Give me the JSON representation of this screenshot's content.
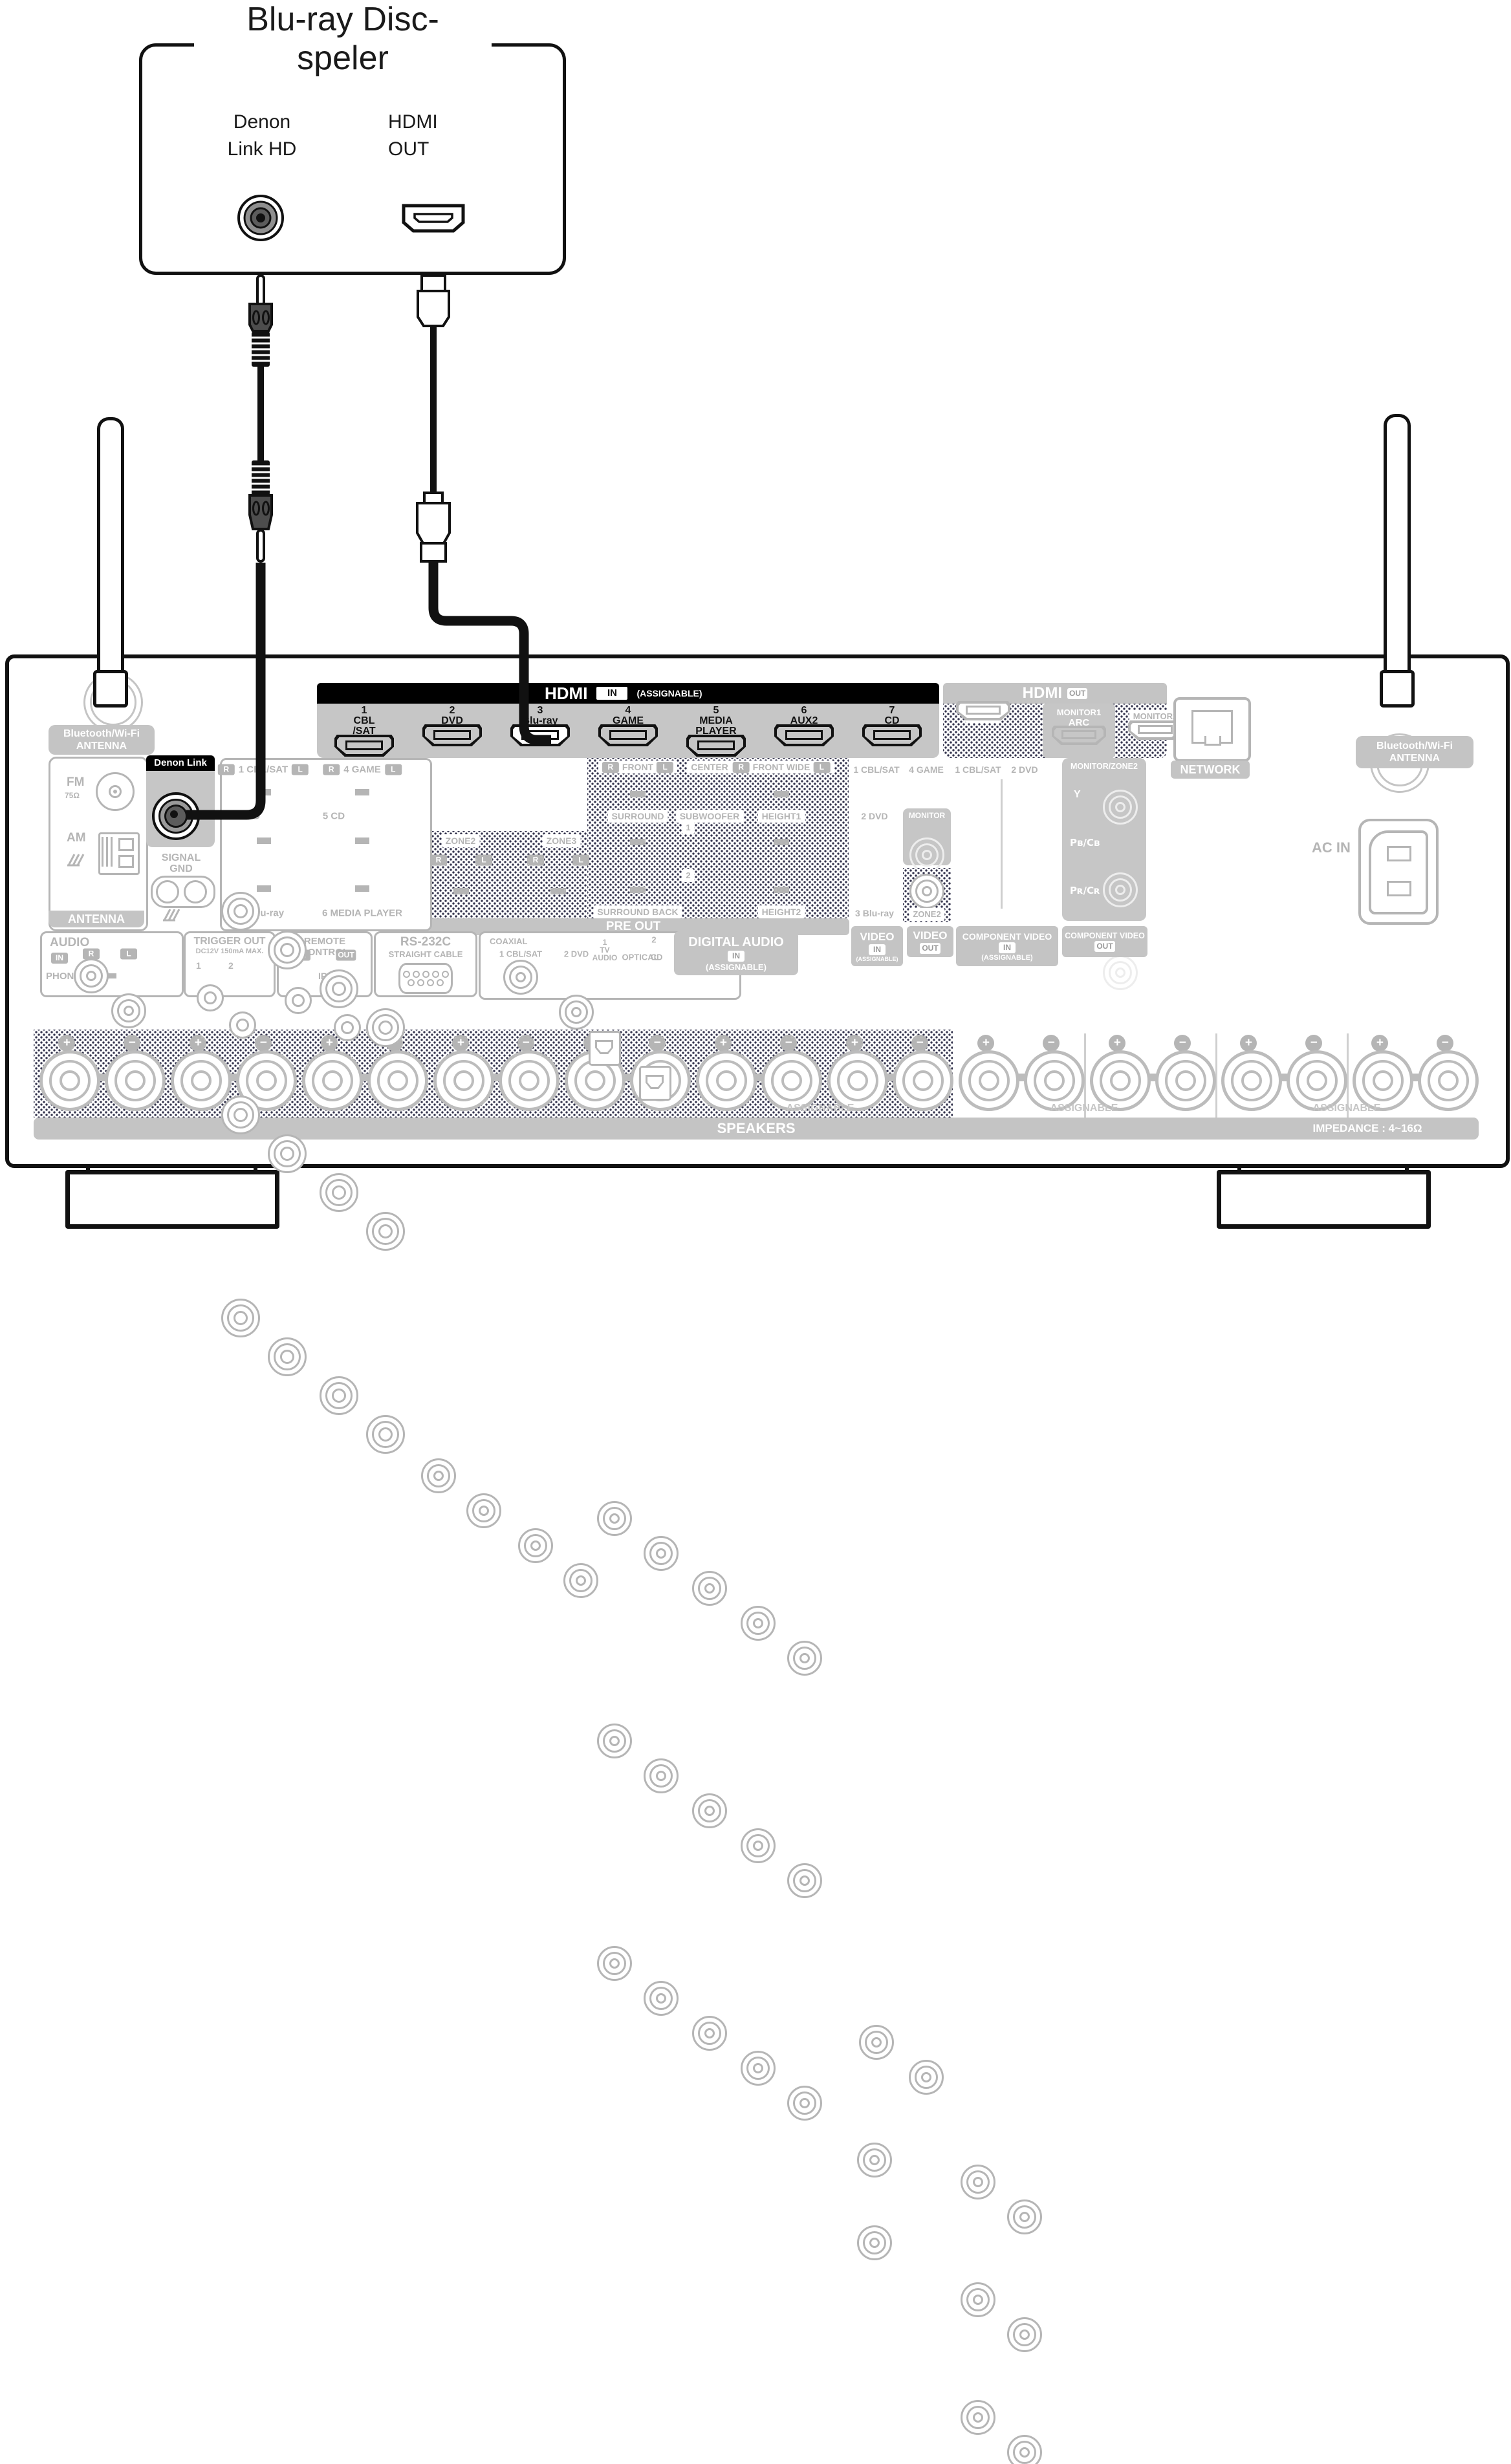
{
  "player": {
    "title": "Blu-ray Disc-\nspeler",
    "denon_link_label": "Denon\nLink HD",
    "hdmi_out_label": "HDMI\nOUT"
  },
  "receiver": {
    "bt_antenna": "Bluetooth/Wi-Fi\nANTENNA",
    "hdmi_in": {
      "title": "HDMI",
      "badge": "IN",
      "note": "(ASSIGNABLE)",
      "ports": [
        {
          "n": "1",
          "name": "CBL\n/SAT"
        },
        {
          "n": "2",
          "name": "DVD"
        },
        {
          "n": "3",
          "name": "Blu-ray"
        },
        {
          "n": "4",
          "name": "GAME"
        },
        {
          "n": "5",
          "name": "MEDIA\nPLAYER"
        },
        {
          "n": "6",
          "name": "AUX2"
        },
        {
          "n": "7",
          "name": "CD"
        }
      ]
    },
    "hdmi_out": {
      "title": "HDMI",
      "badge": "OUT",
      "zone2": "ZONE2",
      "monitor1": "MONITOR1",
      "arc": "ARC",
      "monitor2": "MONITOR2"
    },
    "network": "NETWORK",
    "antenna": {
      "fm": "FM",
      "ohm": "75Ω",
      "am": "AM",
      "banner": "ANTENNA"
    },
    "denon_link": {
      "label": "Denon Link HD",
      "gnd": "SIGNAL\nGND"
    },
    "audio_in": {
      "title": "AUDIO",
      "badge": "IN",
      "note": "(ASSIGNABLE)",
      "r": "R",
      "l": "L",
      "in1": "1 CBL/SAT",
      "in4": "4 GAME",
      "in2": "2 DVD",
      "in5": "5 CD",
      "in3": "3 Blu-ray",
      "in6": "6 MEDIA PLAYER"
    },
    "preout": {
      "banner": "PRE OUT",
      "zone2": "ZONE2",
      "zone3": "ZONE3",
      "r": "R",
      "l": "L",
      "front": "FRONT",
      "center": "CENTER",
      "front_wide": "FRONT WIDE",
      "surround": "SURROUND",
      "subwoofer": "SUBWOOFER",
      "height1": "HEIGHT1",
      "sub1": "1",
      "sub2": "2",
      "surround_back": "SURROUND BACK",
      "height2": "HEIGHT2"
    },
    "phono": {
      "title": "AUDIO",
      "badge": "IN",
      "r": "R",
      "l": "L",
      "name": "PHONO"
    },
    "trigger": {
      "title": "TRIGGER OUT",
      "spec": "DC12V 150mA MAX.",
      "j1": "1",
      "j2": "2"
    },
    "remote": {
      "title": "REMOTE CONTROL",
      "in": "IN",
      "out": "OUT",
      "ir": "IR"
    },
    "rs232c": {
      "title": "RS-232C",
      "sub": "STRAIGHT CABLE"
    },
    "digital": {
      "coaxial": "COAXIAL",
      "c1": "1 CBL/SAT",
      "c2": "2 DVD",
      "opt1": "1\nTV\nAUDIO",
      "optical": "OPTICAL",
      "opt2n": "2",
      "opt2": "CD",
      "title": "DIGITAL AUDIO",
      "badge": "IN",
      "note": "(ASSIGNABLE)"
    },
    "video": {
      "in1": "1 CBL/SAT",
      "in4": "4 GAME",
      "in2": "2 DVD",
      "monitor": "MONITOR",
      "in3": "3 Blu-ray",
      "zone2": "ZONE2",
      "in_title": "VIDEO",
      "in_badge": "IN",
      "note": "(ASSIGNABLE)",
      "out_title": "VIDEO",
      "out_badge": "OUT"
    },
    "component": {
      "in1": "1 CBL/SAT",
      "in2": "2 DVD",
      "out_head": "MONITOR/ZONE2",
      "y": "Y",
      "pb": "Pʙ/Cʙ",
      "pr": "Pʀ/Cʀ",
      "in_title": "COMPONENT VIDEO",
      "in_badge": "IN",
      "note": "(ASSIGNABLE)",
      "out_title": "COMPONENT VIDEO",
      "out_badge": "OUT"
    },
    "ac_in": "AC IN",
    "speakers": {
      "banner": "SPEAKERS",
      "impedance": "IMPEDANCE : 4~16Ω",
      "assignable": "ASSIGNABLE",
      "labels": [
        {
          "text": "FRONT",
          "ch": "R",
          "bg": "#e29a8a",
          "fg": "#ffffff"
        },
        {
          "text": "FRONT",
          "ch": "L",
          "bg": "#ffffff",
          "fg": "#c9c9c9"
        },
        {
          "text": "CENTER",
          "ch": "",
          "bg": "#aac4a3",
          "fg": "#ffffff"
        },
        {
          "text": "SURROUND",
          "ch": "R",
          "bg": "#c4dfe9",
          "fg": "#ffffff"
        },
        {
          "text": "SURROUND",
          "ch": "L",
          "bg": "#edf4f6",
          "fg": "#cccccc"
        },
        {
          "text": "SURROUND BACK",
          "ch": "R",
          "bg": "#c79a6a",
          "fg": "#1c1c1c"
        },
        {
          "text": "SURROUND BACK",
          "ch": "L",
          "bg": "#e4cfb4",
          "fg": "#b9b9b9"
        },
        {
          "text": "FRONT WIDE/HEIGHT2",
          "ch": "R",
          "bg": "#a89cc8",
          "fg": "#ffffff"
        },
        {
          "text": "FRONT WIDE/HEIGHT2",
          "ch": "L",
          "bg": "#dcd8eb",
          "fg": "#c9c9c9"
        },
        {
          "text": "HEIGHT1",
          "ch": "R",
          "bg": "#e6ca90",
          "fg": "#ffffff"
        },
        {
          "text": "HEIGHT1",
          "ch": "L",
          "bg": "#f5edca",
          "fg": "#cfcfcf"
        }
      ]
    }
  }
}
